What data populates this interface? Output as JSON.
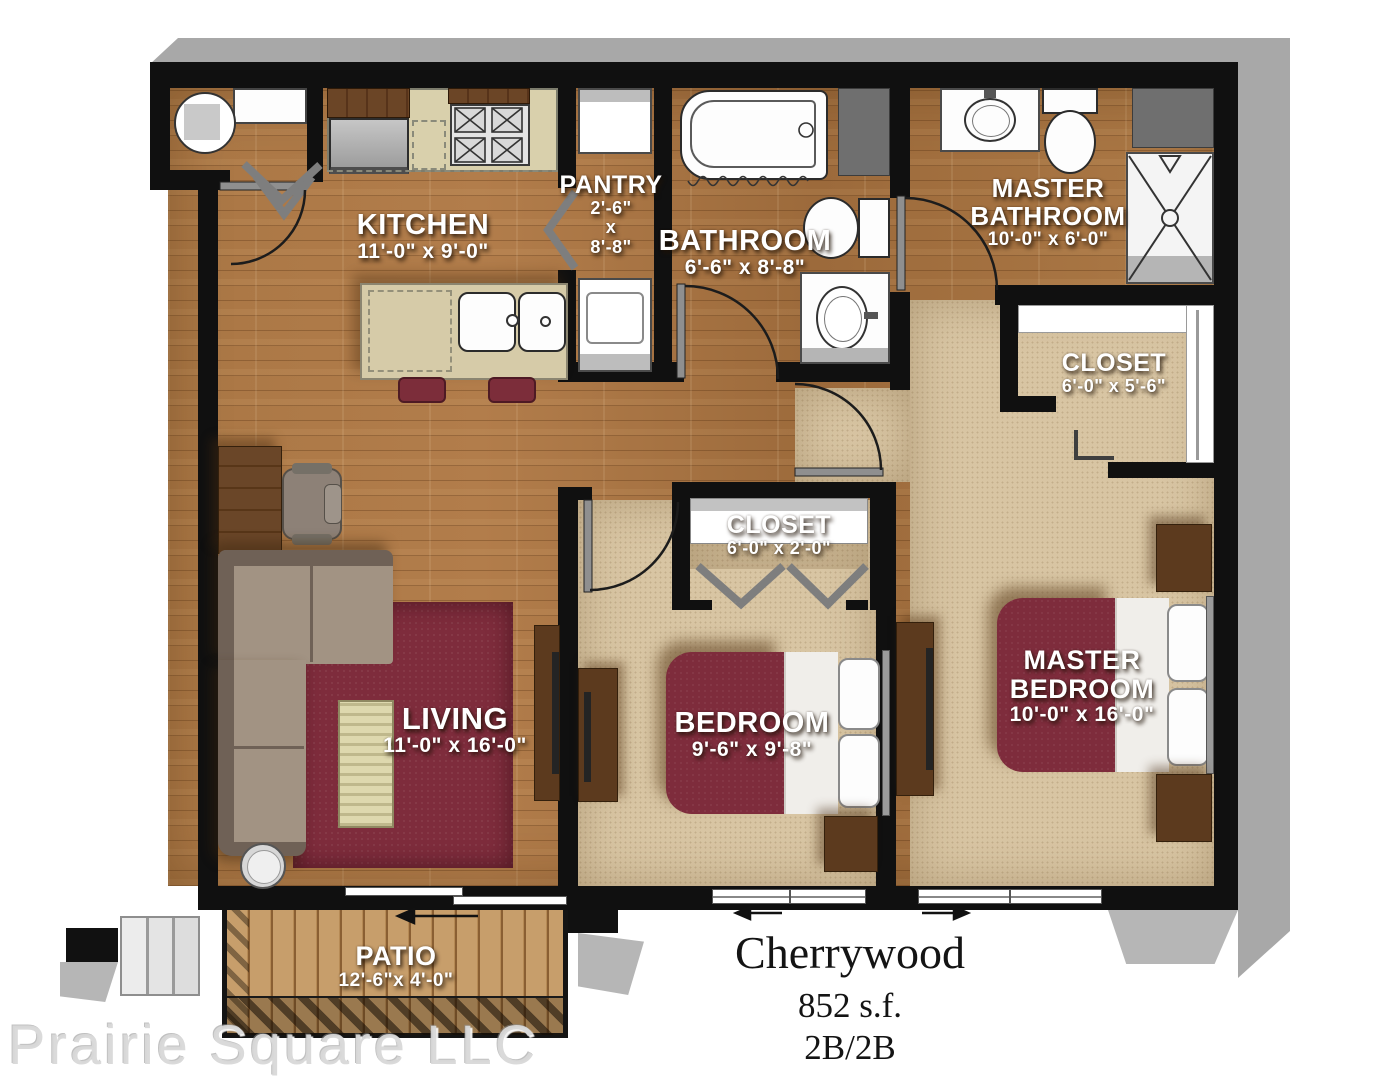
{
  "plan": {
    "name": "Cherrywood",
    "area": "852 s.f.",
    "config": "2B/2B"
  },
  "watermark": "Prairie Square LLC",
  "rooms": {
    "kitchen": {
      "label": "KITCHEN",
      "dims": "11'-0\" x 9'-0\""
    },
    "pantry": {
      "label": "PANTRY",
      "dims_w": "2'-6\"",
      "dims_sep": "x",
      "dims_h": "8'-8\""
    },
    "bathroom": {
      "label": "BATHROOM",
      "dims": "6'-6\" x 8'-8\""
    },
    "master_bathroom": {
      "label": "MASTER BATHROOM",
      "dims": "10'-0\" x 6'-0\""
    },
    "master_closet": {
      "label": "CLOSET",
      "dims": "6'-0\" x 5'-6\""
    },
    "hall_closet": {
      "label": "CLOSET",
      "dims": "6'-0\" x 2'-0\""
    },
    "living": {
      "label": "LIVING",
      "dims": "11'-0\" x 16'-0\""
    },
    "bedroom": {
      "label": "BEDROOM",
      "dims": "9'-6\" x 9'-8\""
    },
    "master_bedroom": {
      "label": "MASTER BEDROOM",
      "dims": "10'-0\" x 16'-0\""
    },
    "patio": {
      "label": "PATIO",
      "dims": "12'-6\"x 4'-0\""
    }
  },
  "palette": {
    "wall": "#101010",
    "wood_floor": "#a9743f",
    "carpet": "#d8c5a3",
    "accent_maroon": "#7e2c3c",
    "furniture_wood": "#5c3a1e",
    "shadow_gray": "#a8a8a8",
    "fixture_white": "#ffffff"
  }
}
